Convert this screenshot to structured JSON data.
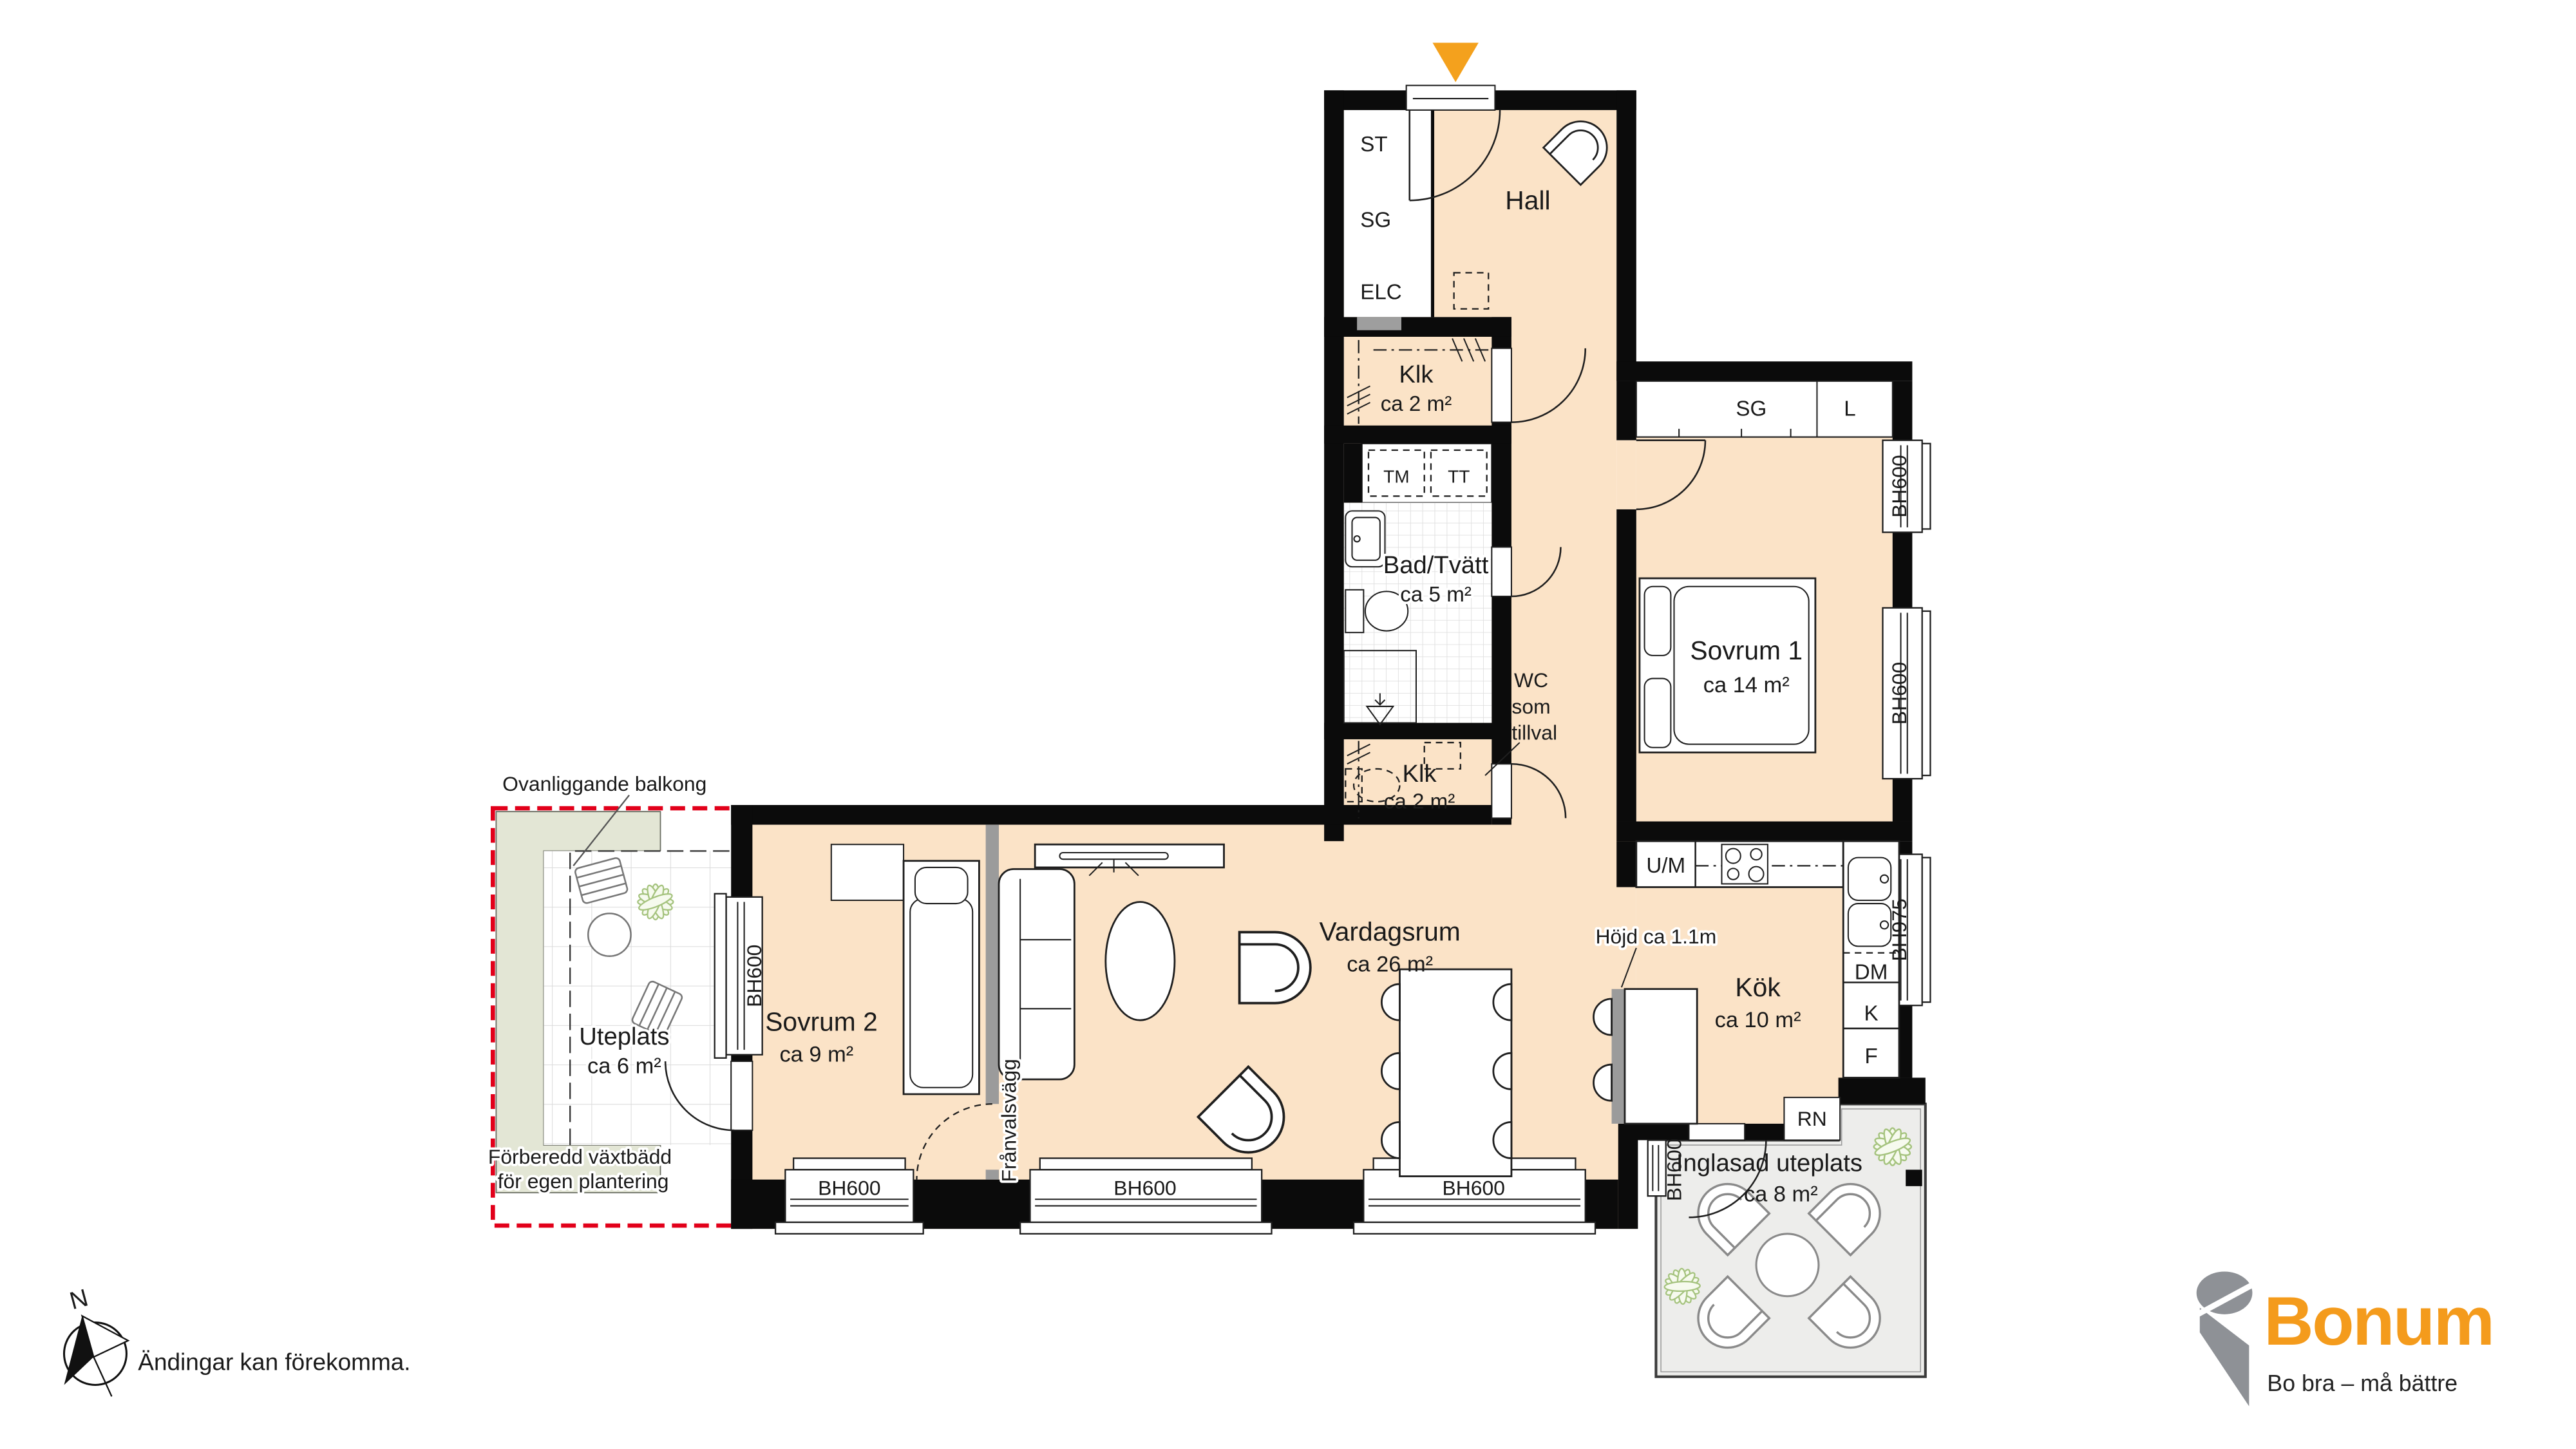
{
  "rooms": {
    "hall": {
      "name": "Hall"
    },
    "klk_upper": {
      "name": "Klk",
      "area": "ca 2 m²"
    },
    "bad": {
      "name": "Bad/Tvätt",
      "area": "ca 5 m²"
    },
    "klk_lower": {
      "name": "Klk",
      "area": "ca 2 m²"
    },
    "sovrum1": {
      "name": "Sovrum 1",
      "area": "ca 14 m²"
    },
    "sovrum2": {
      "name": "Sovrum 2",
      "area": "ca 9 m²"
    },
    "vardagsrum": {
      "name": "Vardagsrum",
      "area": "ca 26 m²"
    },
    "kok": {
      "name": "Kök",
      "area": "ca 10 m²"
    },
    "uteplats": {
      "name": "Uteplats",
      "area": "ca 6 m²"
    },
    "inglasad_uteplats": {
      "name": "Inglasad uteplats",
      "area": "ca 8 m²"
    }
  },
  "fixtures": {
    "st": "ST",
    "sg": "SG",
    "elc": "ELC",
    "tm": "TM",
    "tt": "TT",
    "sg2": "SG",
    "l": "L",
    "um": "U/M",
    "dm": "DM",
    "k": "K",
    "f": "F",
    "rn": "RN"
  },
  "windows": {
    "bh600": "BH600",
    "bh975": "BH975"
  },
  "annotations": {
    "wc_line1": "WC",
    "wc_line2": "som",
    "wc_line3": "tillval",
    "hojd": "Höjd ca 1.1m",
    "franvalsvagg": "Frånvalsvägg",
    "ovanliggande_balkong": "Ovanliggande balkong",
    "vaxtbadd_line1": "Förberedd växtbädd",
    "vaxtbadd_line2": "för egen plantering"
  },
  "compass": {
    "north": "N"
  },
  "disclaimer": "Ändingar kan förekomma.",
  "logo": {
    "brand": "Bonum",
    "tagline": "Bo bra – må bättre"
  },
  "icons": {
    "entrance_arrow": "triangle-down",
    "north_arrow": "compass-needle"
  },
  "colors": {
    "floor": "#FBE3C7",
    "wall": "#0B0B0B",
    "accent_orange": "#F4A11D",
    "boundary_red": "#E2001A",
    "plant_green": "#A5C37E",
    "planting_bed": "#E3E6D5",
    "patio_floor": "#EDEDEB",
    "optional_wall_gray": "#9B9B9B"
  }
}
